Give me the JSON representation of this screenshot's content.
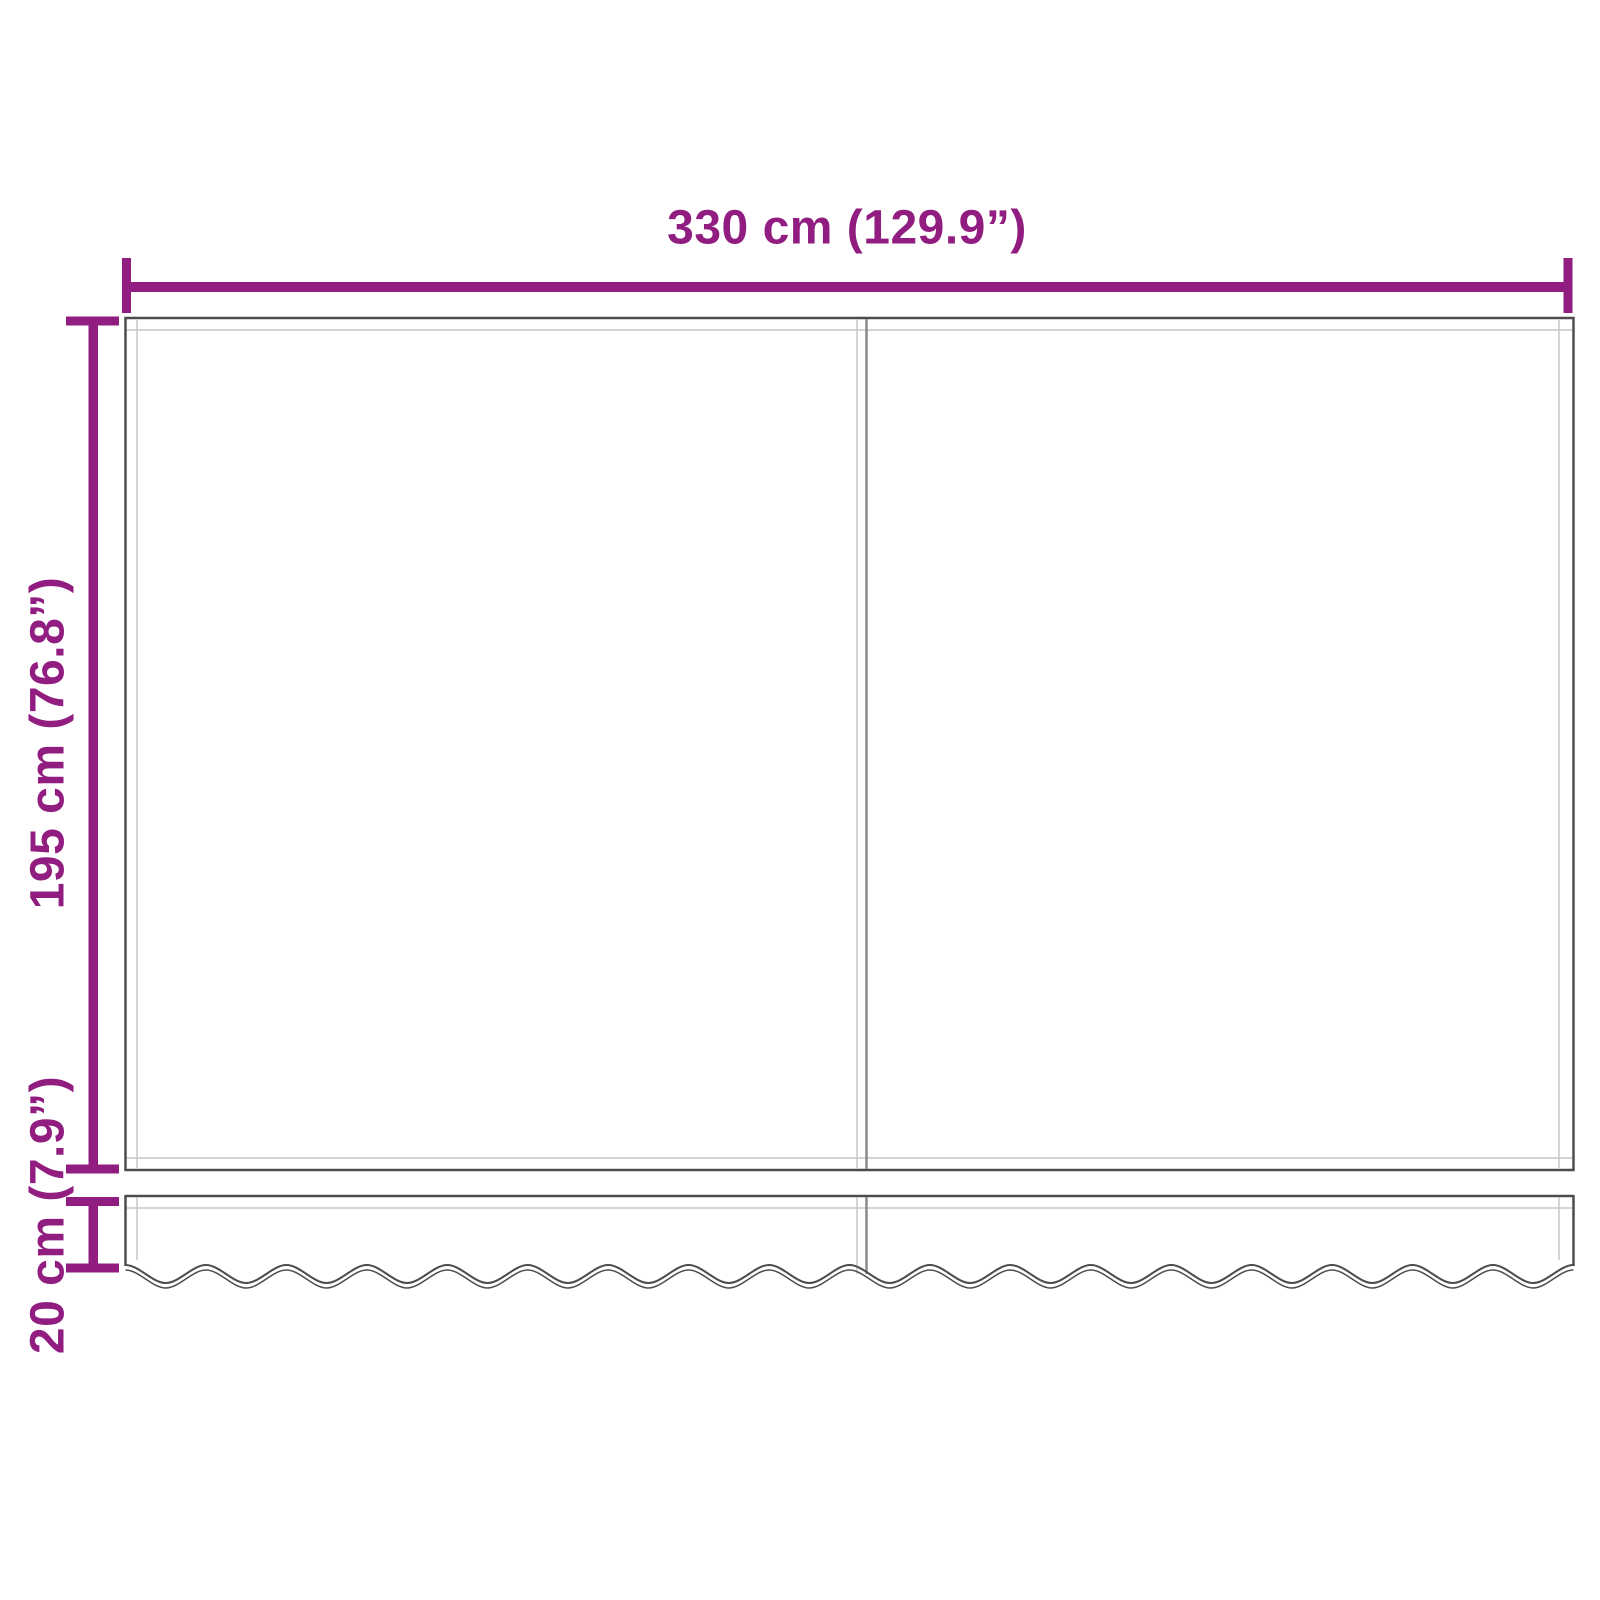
{
  "labels": {
    "width": "330 cm (129.9”)",
    "height": "195 cm (76.8”)",
    "valance_height": "20 cm (7.9”)"
  },
  "colors": {
    "accent": "#911d80",
    "outline": "#4d4d4d",
    "seam": "#c6c6c6",
    "divider": "#8a8a8a",
    "background": "#ffffff"
  }
}
